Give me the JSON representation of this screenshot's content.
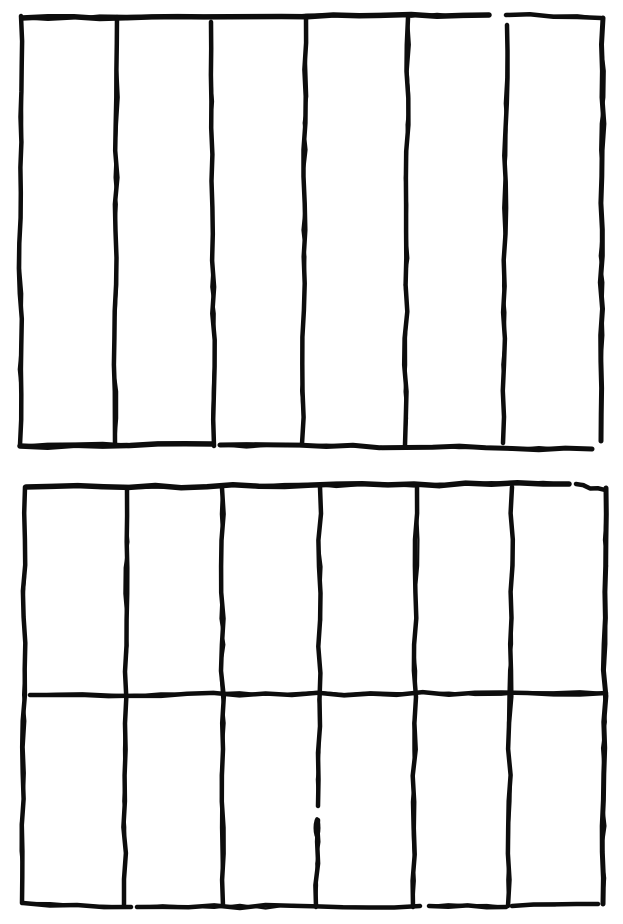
{
  "figure": {
    "title": "Hand-drawn ink sketch of two column grids",
    "background": "#ffffff",
    "ink_color": "#0d0d0d",
    "canvas": {
      "width": 623,
      "height": 924
    }
  },
  "grids": [
    {
      "name": "top-grid",
      "rows": 1,
      "columns": 6,
      "strokes": [
        {
          "name": "top-border-left",
          "x1": 22,
          "y1": 18,
          "x2": 489,
          "y2": 15,
          "w": 5.5
        },
        {
          "name": "top-border-right",
          "x1": 506,
          "y1": 15,
          "x2": 601,
          "y2": 18,
          "w": 4.5
        },
        {
          "name": "left-border",
          "x1": 21,
          "y1": 16,
          "x2": 20,
          "y2": 445,
          "w": 4.5
        },
        {
          "name": "column-divider-1",
          "x1": 117,
          "y1": 17,
          "x2": 115,
          "y2": 445,
          "w": 4.5
        },
        {
          "name": "column-divider-2",
          "x1": 211,
          "y1": 22,
          "x2": 214,
          "y2": 446,
          "w": 4.5
        },
        {
          "name": "column-divider-3",
          "x1": 306,
          "y1": 16,
          "x2": 302,
          "y2": 444,
          "w": 4.5
        },
        {
          "name": "column-divider-4",
          "x1": 408,
          "y1": 18,
          "x2": 405,
          "y2": 445,
          "w": 4.5
        },
        {
          "name": "column-divider-5",
          "x1": 507,
          "y1": 25,
          "x2": 503,
          "y2": 443,
          "w": 4.5
        },
        {
          "name": "right-border",
          "x1": 603,
          "y1": 18,
          "x2": 601,
          "y2": 441,
          "w": 5
        },
        {
          "name": "bottom-border-left",
          "x1": 20,
          "y1": 446,
          "x2": 213,
          "y2": 444,
          "w": 5.5
        },
        {
          "name": "bottom-border-right",
          "x1": 220,
          "y1": 445,
          "x2": 592,
          "y2": 449,
          "w": 5
        }
      ],
      "blobs": []
    },
    {
      "name": "bottom-grid",
      "rows": 2,
      "columns": 6,
      "strokes": [
        {
          "name": "top-border-left",
          "x1": 26,
          "y1": 487,
          "x2": 569,
          "y2": 484,
          "w": 5.5
        },
        {
          "name": "top-border-right",
          "x1": 576,
          "y1": 484,
          "x2": 605,
          "y2": 490,
          "w": 4.5
        },
        {
          "name": "left-border",
          "x1": 25,
          "y1": 487,
          "x2": 22,
          "y2": 903,
          "w": 4.5
        },
        {
          "name": "column-divider-1",
          "x1": 127,
          "y1": 490,
          "x2": 124,
          "y2": 905,
          "w": 4.5
        },
        {
          "name": "column-divider-2",
          "x1": 222,
          "y1": 488,
          "x2": 223,
          "y2": 906,
          "w": 4.5
        },
        {
          "name": "column-divider-3-upper",
          "x1": 320,
          "y1": 487,
          "x2": 318,
          "y2": 806,
          "w": 4.5
        },
        {
          "name": "column-divider-3-lower",
          "x1": 318,
          "y1": 820,
          "x2": 316,
          "y2": 907,
          "w": 4.5
        },
        {
          "name": "column-divider-4",
          "x1": 417,
          "y1": 487,
          "x2": 413,
          "y2": 907,
          "w": 4.5
        },
        {
          "name": "column-divider-5",
          "x1": 512,
          "y1": 487,
          "x2": 508,
          "y2": 906,
          "w": 4.5
        },
        {
          "name": "right-border",
          "x1": 606,
          "y1": 488,
          "x2": 603,
          "y2": 904,
          "w": 5
        },
        {
          "name": "row-divider",
          "x1": 30,
          "y1": 695,
          "x2": 606,
          "y2": 693,
          "w": 4.5
        },
        {
          "name": "bottom-border-a",
          "x1": 23,
          "y1": 903,
          "x2": 131,
          "y2": 907,
          "w": 4.5
        },
        {
          "name": "bottom-border-b",
          "x1": 137,
          "y1": 907,
          "x2": 420,
          "y2": 906,
          "w": 4.5
        },
        {
          "name": "bottom-border-c",
          "x1": 429,
          "y1": 906,
          "x2": 506,
          "y2": 907,
          "w": 4.5
        },
        {
          "name": "bottom-border-d",
          "x1": 512,
          "y1": 906,
          "x2": 598,
          "y2": 904,
          "w": 4.5
        }
      ],
      "blobs": [
        {
          "name": "ink-blob",
          "cx": 317,
          "cy": 828,
          "rx": 3.5,
          "ry": 11
        }
      ]
    }
  ]
}
